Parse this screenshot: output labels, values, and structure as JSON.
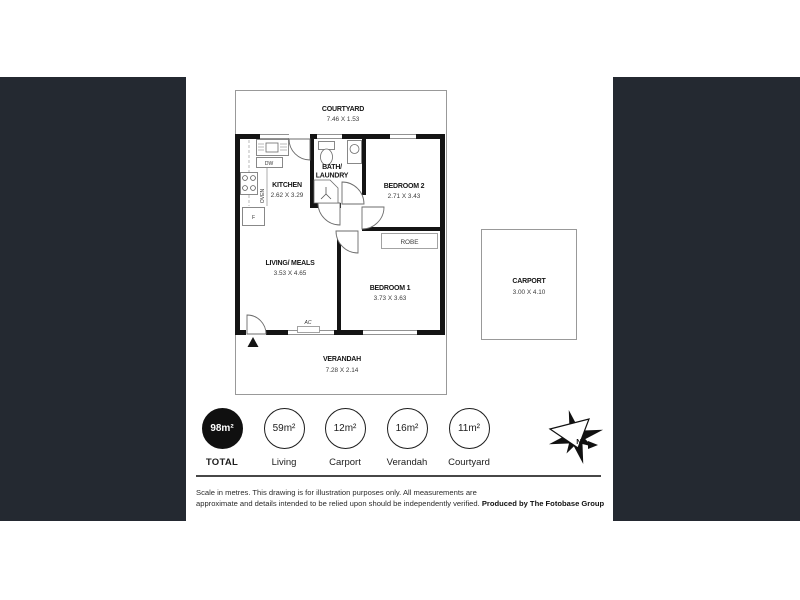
{
  "colors": {
    "panel": "#242931",
    "wall": "#141414",
    "boundary": "#999999",
    "total_circle": "#101010"
  },
  "floorplan": {
    "courtyard": {
      "name": "COURTYARD",
      "dims": "7.46 X 1.53"
    },
    "kitchen": {
      "name": "KITCHEN",
      "dims": "2.62 X 3.29"
    },
    "bath_laundry": {
      "name_line1": "BATH/",
      "name_line2": "LAUNDRY"
    },
    "bedroom2": {
      "name": "BEDROOM 2",
      "dims": "2.71 X 3.43"
    },
    "robe": {
      "name": "ROBE"
    },
    "living_meals": {
      "name": "LIVING/ MEALS",
      "dims": "3.53 X 4.65"
    },
    "bedroom1": {
      "name": "BEDROOM 1",
      "dims": "3.73 X 3.63"
    },
    "verandah": {
      "name": "VERANDAH",
      "dims": "7.28 X 2.14"
    },
    "carport": {
      "name": "CARPORT",
      "dims": "3.00 X 4.10"
    },
    "labels": {
      "dishwasher": "DW",
      "oven": "OVEN",
      "fridge": "F",
      "aircon": "AC"
    }
  },
  "areas": {
    "total": {
      "value": "98m²",
      "label": "TOTAL"
    },
    "items": [
      {
        "value": "59m²",
        "label": "Living"
      },
      {
        "value": "12m²",
        "label": "Carport"
      },
      {
        "value": "16m²",
        "label": "Verandah"
      },
      {
        "value": "11m²",
        "label": "Courtyard"
      }
    ]
  },
  "footer": {
    "disclaimer_line1": "Scale in metres. This drawing is for illustration purposes only. All measurements are",
    "disclaimer_line2": "approximate and details intended to be relied upon should be independently verified.",
    "produced_by": "Produced by The Fotobase Group"
  }
}
